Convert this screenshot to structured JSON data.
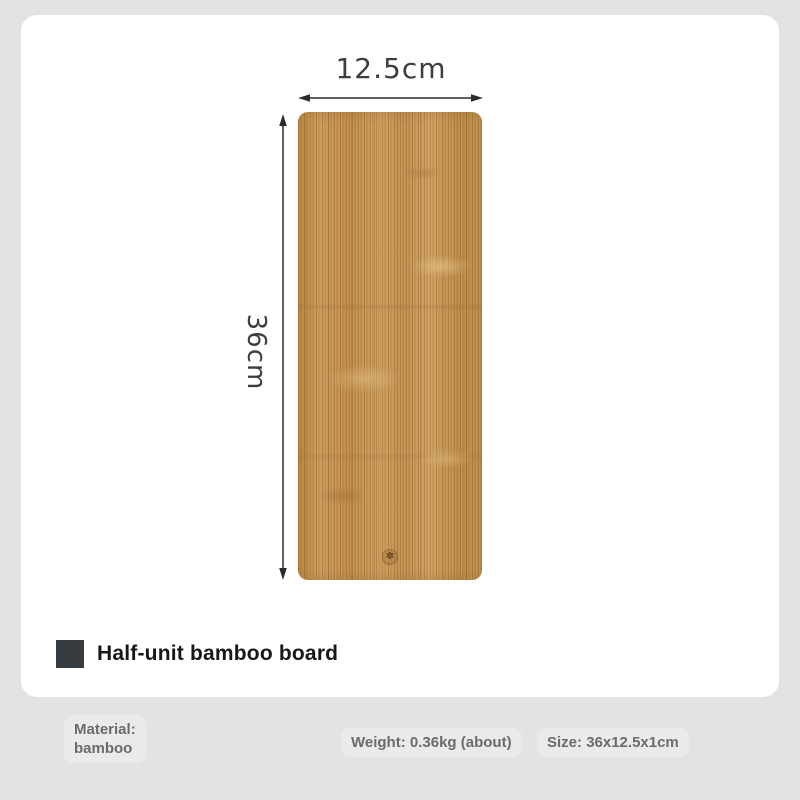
{
  "figure": {
    "width_dimension": "12.5cm",
    "height_dimension": "36cm",
    "board": {
      "description": "bamboo board with vertical grain",
      "base_color": "#c59353",
      "light_grain_color": "#d4a768",
      "dark_grain_color": "#96662a",
      "stamp_glyph": "✽"
    }
  },
  "title": {
    "text": "Half-unit bamboo board",
    "bullet_color": "#363b40"
  },
  "specs": {
    "material": {
      "label": "Material:",
      "value": "bamboo"
    },
    "weight": {
      "label": "Weight:",
      "value": "0.36kg (about)"
    },
    "size": {
      "label": "Size:",
      "value": "36x12.5x1cm"
    }
  },
  "colors": {
    "page_background": "#e3e3e3",
    "card_background": "#ffffff",
    "dimension_text": "#3d3d3d",
    "title_text": "#15181a",
    "spec_text": "#6b6b6b",
    "arrow": "#2b2b2b"
  }
}
